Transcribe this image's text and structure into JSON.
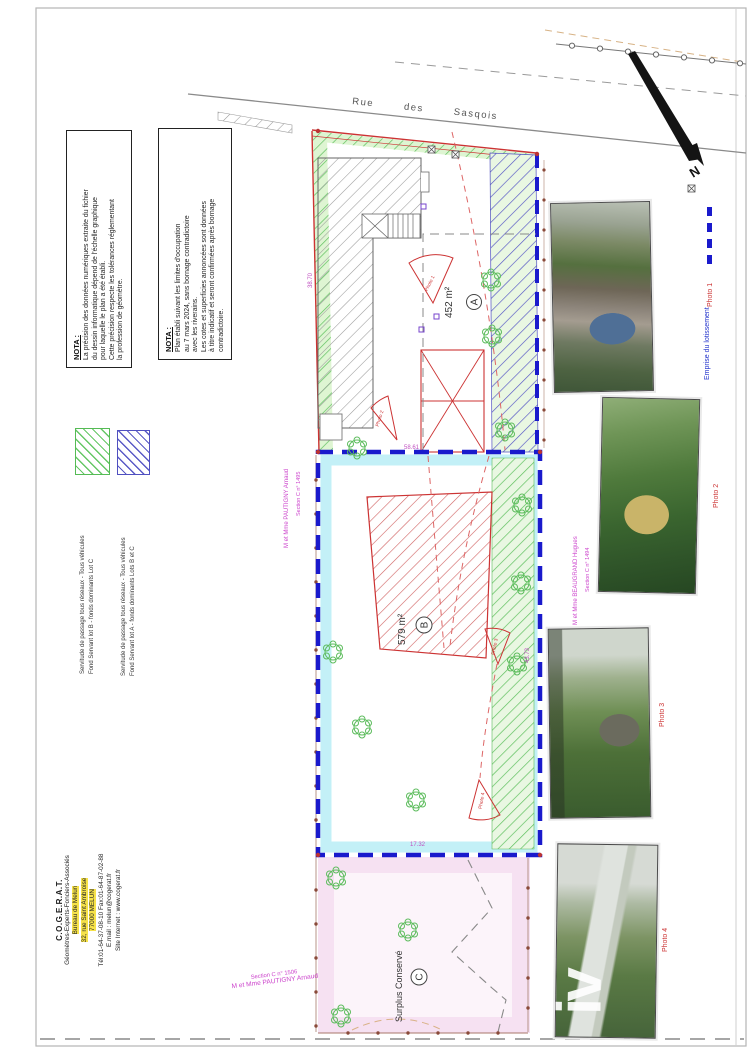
{
  "nota_primary": {
    "title": "NOTA :",
    "lines": [
      "Plan établi suivant les limites d'occupation",
      "au 7 mars 2024, sans bornage contradictoire",
      "avec les riverains.",
      "Les cotes et superficies annoncées sont données",
      "à titre indicatif et seront confirmées après bornage",
      "contradictoire."
    ]
  },
  "nota_secondary": {
    "title": "NOTA :",
    "lines": [
      "La précision des données numériques extraite du fichier",
      "du dessin informatique dépend de l'échelle graphique",
      "pour laquelle le plan a été établi.",
      "Cette précision respecte les tolérances réglementant",
      "la profession de géomètre."
    ]
  },
  "servitude_legend": {
    "items": [
      {
        "swatch": "green-hatch",
        "color": "#55bb55",
        "line1": "Servitude de passage tous réseaux - Tous véhicules",
        "line2": "Fond Servant lot B - fonds dominants Lot C"
      },
      {
        "swatch": "blue-hatch",
        "color": "#5050c0",
        "line1": "Servitude de passage tous réseaux - Tous véhicules",
        "line2": "Fond Servant lot A - fonds dominants Lots B et C"
      }
    ]
  },
  "emprise_legend": {
    "label": "Emprise du lotissement",
    "color": "#2233cc"
  },
  "plan": {
    "street_name": "Rue des Sasqois",
    "north_label": "N",
    "lot_a": {
      "letter": "A",
      "area": "452 m²"
    },
    "lot_b": {
      "letter": "B",
      "area": "579 m²"
    },
    "lot_c": {
      "letter": "C",
      "label": "Surplus Conservé"
    },
    "cone_labels": [
      "Photo 1",
      "Photo 2",
      "Photo 3",
      "Photo 4"
    ],
    "dimensions": {
      "lot_a_west": "38.70",
      "lot_b_north": "58.61",
      "lot_b_east": "43.73",
      "lot_b_south": "17.32"
    },
    "neighbors": {
      "west": {
        "section": "Section C n° 1495",
        "owner": "M et Mme PAUTIGNY Arnaud"
      },
      "east": {
        "section": "Section C n° 1494",
        "owner": "M et Mme BEAUGRAND Hugues"
      },
      "south": {
        "section": "Section C n° 1506",
        "owner": "M et Mme PAUTIGNY Arnaud"
      }
    }
  },
  "photos": [
    {
      "label": "Photo 1"
    },
    {
      "label": "Photo 2"
    },
    {
      "label": "Photo 3"
    },
    {
      "label": "Photo 4",
      "watermark": "iv"
    }
  ],
  "company": {
    "name": "C.O.G.E.R.A.T.",
    "lines": [
      "Géomètres-Experts-Fonciers-Associés",
      "Bureau de Melun",
      "32, rue Saint Ambroise",
      "77000 MELUN",
      "Tél:01-64-37-08-10 Fax:01-64-87-02-88",
      "E.mail : melun@cogerat.fr",
      "Site Internet : www.cogerat.fr"
    ]
  }
}
